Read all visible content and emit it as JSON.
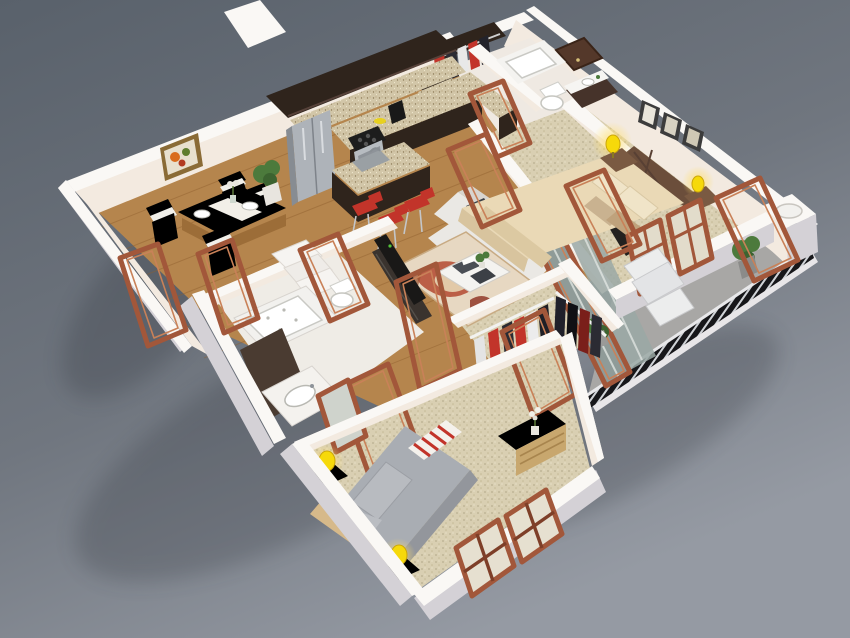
{
  "image": {
    "kind": "3d-isometric-floor-plan-render",
    "description": "Photorealistic isometric 3D render of a two-bedroom apartment floor plan on a grey gradient backdrop. No text labels are present in the image.",
    "width_px": 850,
    "height_px": 638
  },
  "palette": {
    "bg_top": "#59616b",
    "bg_mid": "#70767f",
    "bg_bottom": "#959aa3",
    "wall_top": "#faf8f5",
    "wall_lit": "#f3eae0",
    "wall_shade": "#ddd2c9",
    "wall_gray": "#d4d1d6",
    "floor_wood": "#b5854d",
    "wood_dark": "#8f5f2e",
    "carpet": "#d9cfb2",
    "balcony_floor": "#a8a7a5",
    "railing": "#17171a",
    "door_frame": "#a2573a",
    "door_frame_light": "#c98158",
    "cabinet_dark": "#2f241c",
    "granite": "#d2c6a8",
    "steel": "#aab0b6",
    "accent_red": "#c2342a",
    "sofa_white": "#eae8e4",
    "bed2_cream": "#ead9b6",
    "bed_gray": "#a9adb3",
    "lamp_yellow": "#f6d90a",
    "plant_green": "#4c7a3c",
    "glass": "#9aa8a4",
    "shadow": "#20242c"
  },
  "rooms": [
    {
      "name": "Kitchen",
      "features": [
        "dark espresso upper and lower cabinets",
        "speckled granite countertop in L shape",
        "stainless refrigerator",
        "range with cooktop",
        "black coffee maker",
        "granite island with sink",
        "three red bar stools"
      ]
    },
    {
      "name": "Dining Area",
      "features": [
        "oak dining table",
        "four chairs with white cushions",
        "white table runner and plates",
        "colorful framed wall art",
        "potted plant"
      ]
    },
    {
      "name": "Living Room",
      "features": [
        "white fabric sofa with dark pillows",
        "patterned red and cream rug",
        "coffee table with books and plant",
        "dark TV console",
        "small framed picture",
        "sliding glass door to balcony"
      ]
    },
    {
      "name": "Bedroom 2",
      "features": [
        "double bed with cream bedding",
        "dark wood cross-brace headboard",
        "two nightstands with lit yellow lamps",
        "three picture frames on wall",
        "dark TV panel",
        "windows to balcony",
        "beige carpet"
      ]
    },
    {
      "name": "Balcony",
      "features": [
        "grey concrete floor",
        "black vertical-slat railing with white cap",
        "lounge chair and ottoman",
        "potted plants",
        "round rooftop vent on wall column"
      ]
    },
    {
      "name": "Hall Bathroom",
      "features": [
        "bathtub",
        "toilet",
        "dark vanity with sink"
      ]
    },
    {
      "name": "Entry",
      "features": [
        "dark wood entry door",
        "coat closet with red, white and dark hanging clothes"
      ]
    },
    {
      "name": "Master Bathroom",
      "features": [
        "jetted tub",
        "dark shower screen",
        "vanity with oval sink",
        "white linen shelves"
      ]
    },
    {
      "name": "Walk-in Closet",
      "features": [
        "two hanging rails",
        "garments in white, red and black",
        "beige carpet"
      ]
    },
    {
      "name": "Master Bedroom",
      "features": [
        "bed with gray bedding",
        "folded red-white striped throw",
        "light wood bed frame and headboard",
        "two nightstands with yellow lamps",
        "light wood dresser with flower vase",
        "tall standing mirror",
        "two brown casement windows",
        "beige carpet"
      ]
    }
  ],
  "style_notes": {
    "doors": "many open reddish-brown wooden door frames standing throughout",
    "flooring": "honey oak planks in kitchen, dining, living and halls; beige speckled carpet in bedrooms and closet; grey concrete on balcony",
    "walls": "white-topped walls with warm cream interior faces",
    "lighting": "warm glow from yellow table lamps in both bedrooms"
  }
}
